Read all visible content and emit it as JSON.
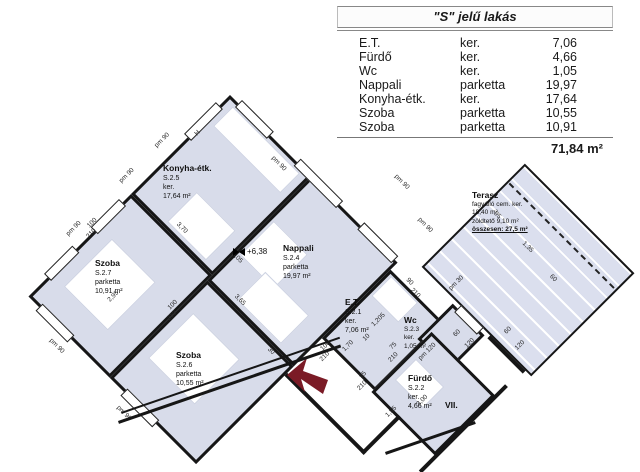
{
  "table": {
    "title": "\"S\" jelű lakás",
    "rows": [
      {
        "name": "E.T.",
        "finish": "ker.",
        "area": "7,06"
      },
      {
        "name": "Fürdő",
        "finish": "ker.",
        "area": "4,66"
      },
      {
        "name": "Wc",
        "finish": "ker.",
        "area": "1,05"
      },
      {
        "name": "Nappali",
        "finish": "parketta",
        "area": "19,97"
      },
      {
        "name": "Konyha-étk.",
        "finish": "ker.",
        "area": "17,64"
      },
      {
        "name": "Szoba",
        "finish": "parketta",
        "area": "10,55"
      },
      {
        "name": "Szoba",
        "finish": "parketta",
        "area": "10,91"
      }
    ],
    "total": "71,84 m²"
  },
  "plan": {
    "colors": {
      "room_fill": "#d8dcea",
      "terrace_fill": "#dbdfee",
      "wall": "#161616",
      "arrow": "#7b1b26"
    },
    "rooms": [
      {
        "id": "konyha",
        "u": 0,
        "v": 0,
        "w": 115,
        "h": 140
      },
      {
        "id": "nappali",
        "u": 115,
        "v": 0,
        "w": 122,
        "h": 147
      },
      {
        "id": "szoba-2-7",
        "u": 0,
        "v": 140,
        "w": 115,
        "h": 145
      },
      {
        "id": "szoba-2-6",
        "u": 115,
        "v": 147,
        "w": 122,
        "h": 138
      },
      {
        "id": "et",
        "u": 237,
        "v": 10,
        "w": 75,
        "h": 97
      },
      {
        "id": "wc",
        "u": 305,
        "v": -10,
        "w": 45,
        "h": 50
      },
      {
        "id": "furdo",
        "u": 310,
        "v": 25,
        "w": 90,
        "h": 85
      },
      {
        "id": "terasz",
        "u": 257,
        "v": -160,
        "w": 155,
        "h": 146,
        "hatch": true
      }
    ],
    "dash_line": {
      "u": 260,
      "v": -136,
      "w": 148
    },
    "furniture": [
      {
        "u": 10,
        "v": 6,
        "w": 95,
        "h": 28
      },
      {
        "u": 45,
        "v": 92,
        "w": 55,
        "h": 42
      },
      {
        "u": 120,
        "v": 58,
        "w": 48,
        "h": 48
      },
      {
        "u": 150,
        "v": 100,
        "w": 62,
        "h": 40
      },
      {
        "u": 18,
        "v": 185,
        "w": 62,
        "h": 68
      },
      {
        "u": 128,
        "v": 180,
        "w": 66,
        "h": 64
      },
      {
        "u": 242,
        "v": 14,
        "w": 38,
        "h": 28
      },
      {
        "u": 318,
        "v": 55,
        "w": 40,
        "h": 30
      }
    ],
    "windows": [
      {
        "u": -5,
        "v": 15,
        "w": 10,
        "h": 45
      },
      {
        "u": -5,
        "v": 152,
        "w": 10,
        "h": 40
      },
      {
        "u": -5,
        "v": 218,
        "w": 10,
        "h": 40
      },
      {
        "u": 15,
        "v": 280,
        "w": 45,
        "h": 10
      },
      {
        "u": 135,
        "v": 280,
        "w": 45,
        "h": 10
      },
      {
        "u": 12,
        "v": -5,
        "w": 45,
        "h": 10
      },
      {
        "u": 95,
        "v": -5,
        "w": 60,
        "h": 10
      },
      {
        "u": 185,
        "v": -5,
        "w": 48,
        "h": 10
      },
      {
        "u": 312,
        "v": -15,
        "w": 32,
        "h": 10
      }
    ],
    "walls": [
      {
        "u": 237,
        "v": 156,
        "w": 112,
        "h": 4
      },
      {
        "u": 345,
        "v": 107,
        "w": 4,
        "h": 53
      },
      {
        "u": 399,
        "v": 10,
        "w": 4,
        "h": 122
      },
      {
        "u": 354,
        "v": -14,
        "w": 50,
        "h": 4
      }
    ],
    "screen_walls": [
      {
        "x": 118,
        "y": 421,
        "w": 235,
        "h": 3,
        "rot": -19
      },
      {
        "x": 121,
        "y": 412,
        "w": 231,
        "h": 1.5,
        "rot": -19
      },
      {
        "x": 385,
        "y": 452,
        "w": 95,
        "h": 3,
        "rot": -19
      }
    ],
    "dims": [
      {
        "t": "pm 90",
        "u": -16,
        "v": 80,
        "r": -90
      },
      {
        "t": "pm 90",
        "u": -16,
        "v": 130,
        "r": -90
      },
      {
        "t": "pm 90",
        "u": -16,
        "v": 205,
        "r": -90
      },
      {
        "t": "pm 90",
        "u": 55,
        "v": 300,
        "r": 0
      },
      {
        "t": "pm 90",
        "u": 150,
        "v": 300,
        "r": 0
      },
      {
        "t": "pm 90",
        "u": 83,
        "v": 14,
        "r": 0
      },
      {
        "t": "pm 90",
        "u": 183,
        "v": -60,
        "r": 0
      },
      {
        "t": "pm 90",
        "u": 230,
        "v": -46,
        "r": 0
      },
      {
        "t": "H",
        "u": 4,
        "v": 50,
        "r": -90
      },
      {
        "t": "100",
        "u": -7,
        "v": 188,
        "r": -90
      },
      {
        "t": "210",
        "u": 0,
        "v": 196,
        "r": -90
      },
      {
        "t": "3,70",
        "u": 60,
        "v": 128,
        "r": 0
      },
      {
        "t": "5,05",
        "u": 120,
        "v": 110,
        "r": 0
      },
      {
        "t": "2,95",
        "u": 60,
        "v": 225,
        "r": -90
      },
      {
        "t": "3,65",
        "u": 152,
        "v": 138,
        "r": 0
      },
      {
        "t": "100",
        "u": 108,
        "v": 189,
        "r": -90
      },
      {
        "t": "210",
        "u": 115,
        "v": 197,
        "r": -90
      },
      {
        "t": "30",
        "u": 210,
        "v": 152,
        "r": 0
      },
      {
        "t": "100",
        "u": 245,
        "v": 110,
        "r": -90
      },
      {
        "t": "210",
        "u": 252,
        "v": 118,
        "r": -90
      },
      {
        "t": "1,70",
        "u": 261,
        "v": 94,
        "r": -90
      },
      {
        "t": "10",
        "u": 268,
        "v": 75,
        "r": -90
      },
      {
        "t": "1,205",
        "u": 264,
        "v": 54,
        "r": -90
      },
      {
        "t": "pm 30",
        "u": 293,
        "v": -27,
        "r": -90
      },
      {
        "t": "75",
        "u": 293,
        "v": 62,
        "r": -90
      },
      {
        "t": "210",
        "u": 301,
        "v": 70,
        "r": -90
      },
      {
        "t": "95",
        "u": 292,
        "v": 104,
        "r": -90
      },
      {
        "t": "210",
        "u": 299,
        "v": 112,
        "r": -90
      },
      {
        "t": "pm 120",
        "u": 321,
        "v": 42,
        "r": -90
      },
      {
        "t": "3,00",
        "u": 352,
        "v": 80,
        "r": -90
      },
      {
        "t": "1,55",
        "u": 338,
        "v": 110,
        "r": -90
      },
      {
        "t": "90",
        "u": 259,
        "v": 5,
        "r": 0
      },
      {
        "t": "210",
        "u": 271,
        "v": 9,
        "r": 0
      },
      {
        "t": "95",
        "u": 274,
        "v": -104,
        "r": 0
      },
      {
        "t": "1,35",
        "u": 318,
        "v": -103,
        "r": 0
      },
      {
        "t": "60",
        "u": 358,
        "v": -99,
        "r": 0
      },
      {
        "t": "60",
        "u": 363,
        "v": -30,
        "r": -90
      },
      {
        "t": "120",
        "u": 382,
        "v": -28,
        "r": -90
      },
      {
        "t": "60",
        "u": 329,
        "v": 8,
        "r": -90
      },
      {
        "t": "120",
        "u": 345,
        "v": 6,
        "r": -90
      }
    ],
    "labels": [
      {
        "id": "konyha",
        "x": 163,
        "y": 163,
        "lines": [
          "Konyha-étk.",
          "S.2.5",
          "ker.",
          "17,64 m²"
        ]
      },
      {
        "id": "nappali",
        "x": 283,
        "y": 243,
        "lines": [
          "Nappali",
          "S.2.4",
          "parketta",
          "19,97 m²"
        ]
      },
      {
        "id": "szoba-27",
        "x": 95,
        "y": 258,
        "lines": [
          "Szoba",
          "S.2.7",
          "parketta",
          "10,91 m²"
        ]
      },
      {
        "id": "szoba-26",
        "x": 176,
        "y": 350,
        "lines": [
          "Szoba",
          "S.2.6",
          "parketta",
          "10,55 m²"
        ]
      },
      {
        "id": "et",
        "x": 345,
        "y": 297,
        "lines": [
          "E.T.",
          "S.2.1",
          "ker.",
          "7,06 m²"
        ]
      },
      {
        "id": "wc",
        "x": 404,
        "y": 315,
        "small": true,
        "lines": [
          "Wc",
          "S.2.3",
          "ker.",
          "1,05 m²"
        ]
      },
      {
        "id": "furdo",
        "x": 408,
        "y": 373,
        "lines": [
          "Fürdő",
          "S.2.2",
          "ker.",
          "4,66 m²"
        ]
      },
      {
        "id": "terasz",
        "x": 472,
        "y": 190,
        "small": true,
        "underline_last": true,
        "lines": [
          "Terasz",
          "fagyálló cem. ker.",
          "18,40 m²",
          "zöldtető 9,10 m²",
          "összesen: 27,5 m²"
        ]
      },
      {
        "id": "vii",
        "x": 445,
        "y": 400,
        "lines": [
          "VII."
        ]
      }
    ],
    "level_marker": {
      "text": "+6,38",
      "x": 233,
      "y": 247
    },
    "arrow": {
      "points": "287,375 307,358 303,371 328,380 323,394 301,379 305,392",
      "color": "#7b1b26"
    }
  }
}
